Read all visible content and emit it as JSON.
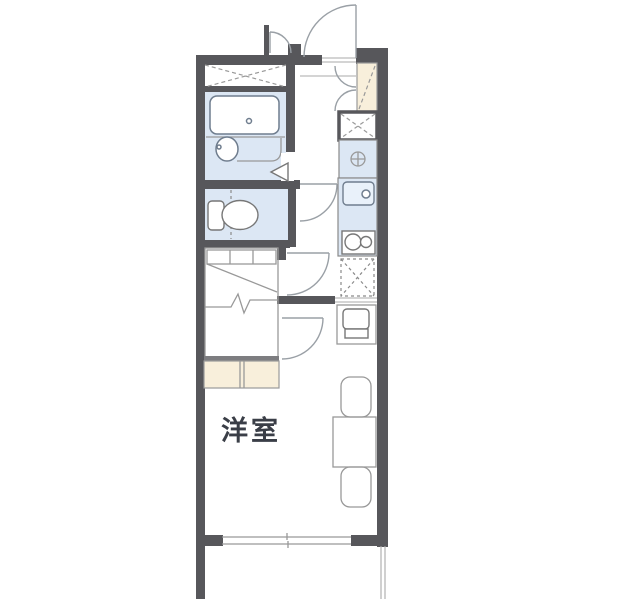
{
  "floorplan": {
    "room_label": "洋室",
    "colors": {
      "wall": "#57575b",
      "wet_area_fill": "#dce7f4",
      "cabinet_fill": "#f8efdb",
      "outline": "#999999",
      "fixture_line": "#6f7d8e",
      "label_text": "#3a3e47",
      "background": "#ffffff"
    }
  }
}
